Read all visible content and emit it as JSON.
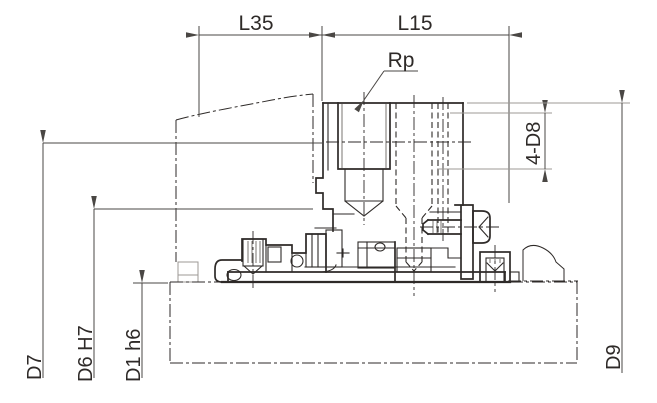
{
  "annotations": {
    "l35": {
      "label": "L35"
    },
    "l15": {
      "label": "L15"
    },
    "rp": {
      "label": "Rp"
    },
    "holes": {
      "label": "4-D8"
    },
    "d7": {
      "label": "D7"
    },
    "d6": {
      "label": "D6 H7"
    },
    "d1": {
      "label": "D1 h6"
    },
    "d9": {
      "label": "D9"
    }
  },
  "colors": {
    "line": "#2e2a28",
    "dim": "#4a4744",
    "extension": "#9c9996",
    "background": "#ffffff"
  }
}
